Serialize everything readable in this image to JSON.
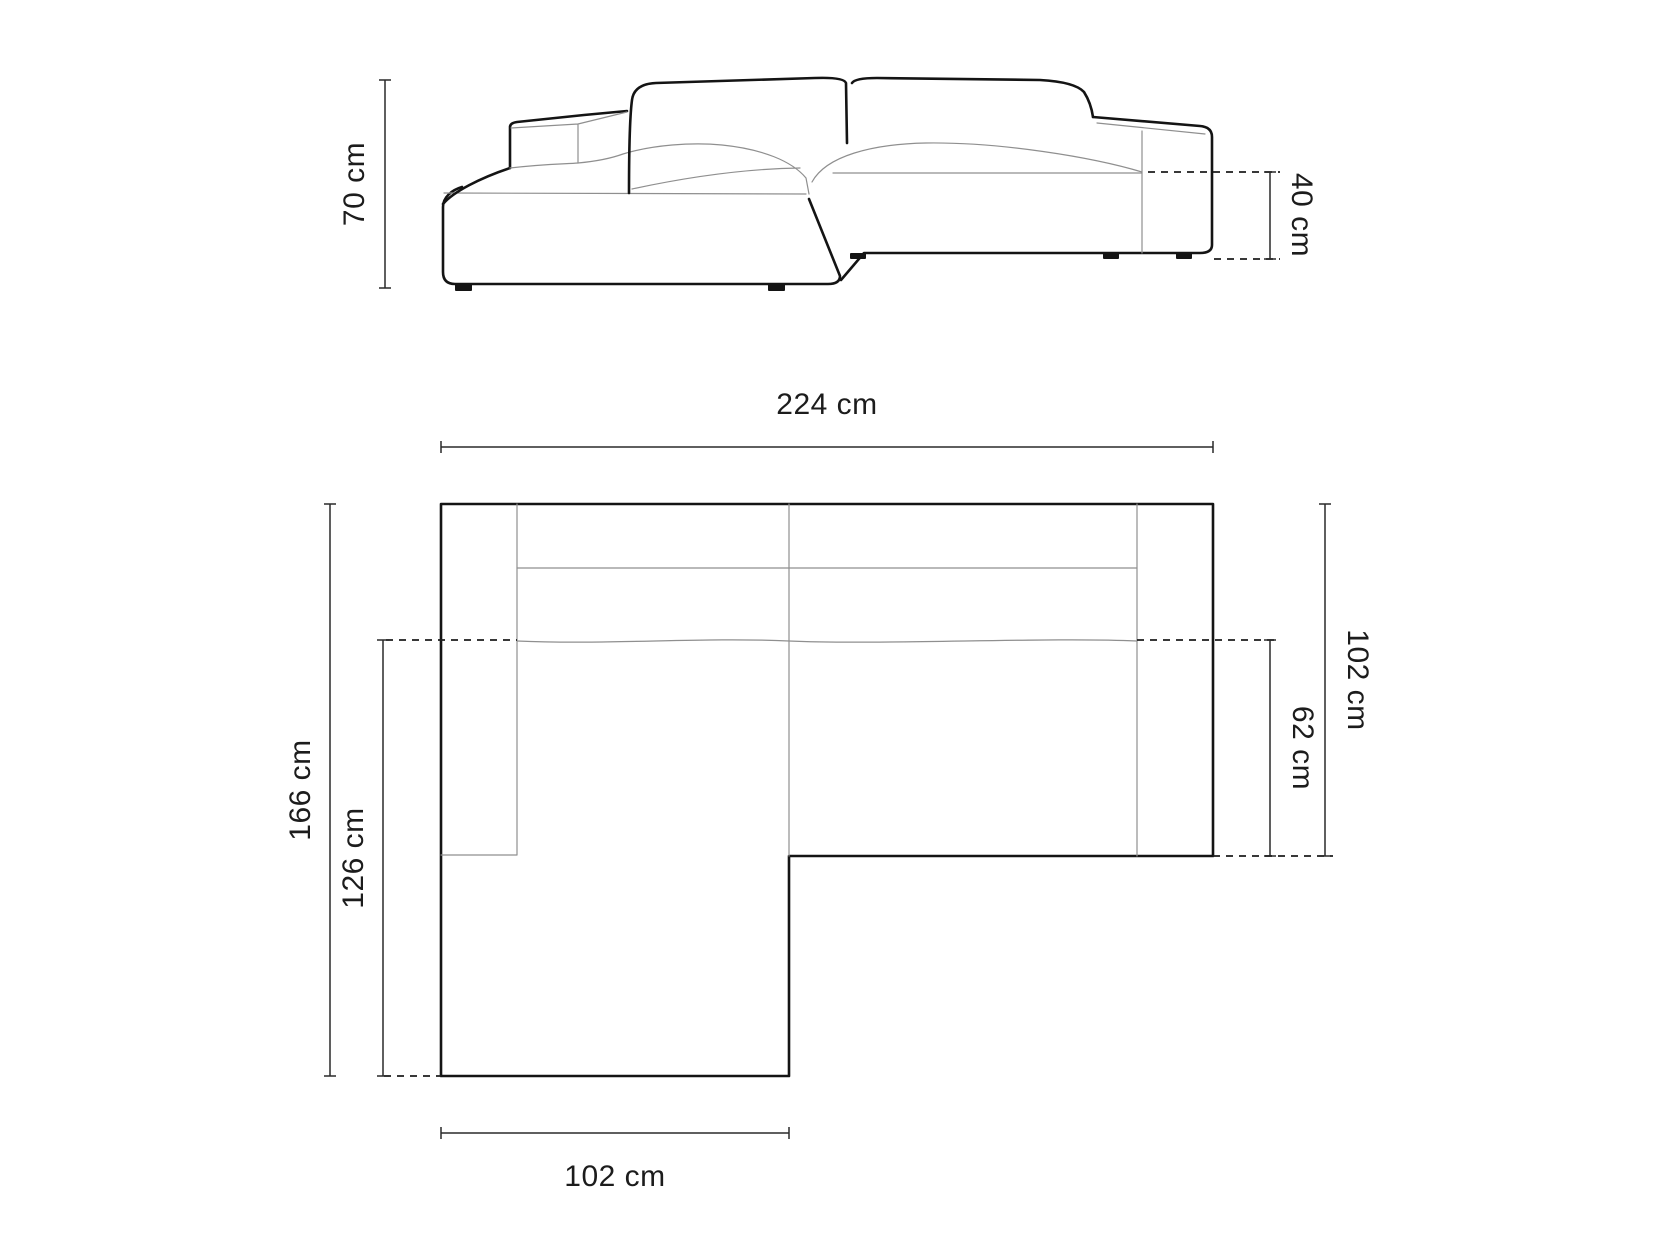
{
  "drawing": {
    "background": "#ffffff",
    "colors": {
      "outline": "#141414",
      "thin_line": "#8f8f8f",
      "dimension_line": "#2a2a2a",
      "dashed_line": "#1d1d1d",
      "text": "#1c1c1c"
    },
    "elevation": {
      "view_name": "sofa-front-elevation",
      "dims": {
        "total_height": {
          "label": "70 cm",
          "value": 70,
          "unit": "cm",
          "orientation": "vertical",
          "side": "left"
        },
        "seat_height": {
          "label": "40 cm",
          "value": 40,
          "unit": "cm",
          "orientation": "vertical",
          "side": "right"
        }
      }
    },
    "plan": {
      "view_name": "sofa-top-view",
      "dims": {
        "total_width": {
          "label": "224 cm",
          "value": 224,
          "unit": "cm",
          "orientation": "horizontal",
          "side": "top"
        },
        "total_depth": {
          "label": "166 cm",
          "value": 166,
          "unit": "cm",
          "orientation": "vertical",
          "side": "left"
        },
        "chaise_depth": {
          "label": "126 cm",
          "value": 126,
          "unit": "cm",
          "orientation": "vertical",
          "side": "left-inner"
        },
        "right_depth": {
          "label": "102 cm",
          "value": 102,
          "unit": "cm",
          "orientation": "vertical",
          "side": "right-outer"
        },
        "seat_depth": {
          "label": "62 cm",
          "value": 62,
          "unit": "cm",
          "orientation": "vertical",
          "side": "right-inner"
        },
        "chaise_width": {
          "label": "102 cm",
          "value": 102,
          "unit": "cm",
          "orientation": "horizontal",
          "side": "bottom"
        }
      }
    }
  }
}
